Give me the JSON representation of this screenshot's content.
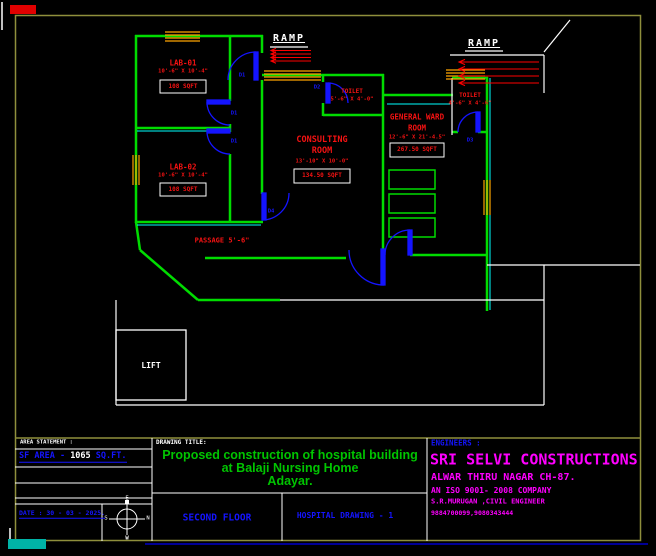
{
  "colors": {
    "wall_green": "#00dc00",
    "accent_cyan": "#00ffff",
    "door_blue": "#1414ff",
    "label_red": "#f51212",
    "text_blue": "#1414ff",
    "title_green": "#00c400",
    "company_magenta": "#ff00ff",
    "border_olive": "#8f8f3c",
    "hatch_orange": "#ffa500",
    "ramp_red": "#ff0000"
  },
  "plan": {
    "ramp1_label": "RAMP",
    "ramp2_label": "RAMP",
    "rooms": {
      "lab01": {
        "name": "LAB-01",
        "dims": "10'-6\" X 10'-4\"",
        "area": "108 SQFT"
      },
      "lab02": {
        "name": "LAB-02",
        "dims": "10'-6\" X 10'-4\"",
        "area": "108 SQFT"
      },
      "consulting": {
        "name1": "CONSULTING",
        "name2": "ROOM",
        "dims": "13'-10\" X 10'-0\"",
        "area": "134.50 SQFT"
      },
      "ward": {
        "name1": "GENERAL WARD",
        "name2": "ROOM",
        "dims": "12'-6\" X 21'-4.5\"",
        "area": "267.50 SQFT"
      },
      "toilet_left": {
        "name": "TOILET",
        "dims": "5'-6\" X 4'-0\""
      },
      "toilet_right": {
        "name": "TOILET",
        "dims": "4'-6\" X 4'-6\""
      },
      "passage": {
        "label": "PASSAGE 5'-6\""
      },
      "lift": {
        "label": "LIFT"
      }
    },
    "door_tags": {
      "d1a": "D1",
      "d1b": "D1",
      "d1c": "D1",
      "d2": "D2",
      "d3": "D3",
      "d4": "D4"
    },
    "compass": {
      "n": "N",
      "s": "S",
      "e": "E",
      "w": "W"
    }
  },
  "title_block": {
    "area_statement_label": "AREA STATEMENT :",
    "sf_area_prefix": "SF AREA - ",
    "sf_area_value": "1065",
    "sf_area_suffix": " SQ.FT.",
    "date": "DATE : 30 - 03 - 2025.",
    "drawing_title_label": "DRAWING TITLE:",
    "title_line1": "Proposed construction of hospital building",
    "title_line2": "at Balaji Nursing Home",
    "title_line3": "Adayar.",
    "floor": "SECOND FLOOR",
    "drawing_no": "HOSPITAL DRAWING - 1",
    "engineers_label": "ENGINEERS :",
    "company": "SRI SELVI CONSTRUCTIONS",
    "address": "ALWAR THIRU NAGAR CH-87.",
    "iso": "AN ISO 9001- 2008 COMPANY",
    "engineer": "S.R.MURUGAN ,CIVIL ENGINEER",
    "phone": "9884700099,9080343444"
  }
}
